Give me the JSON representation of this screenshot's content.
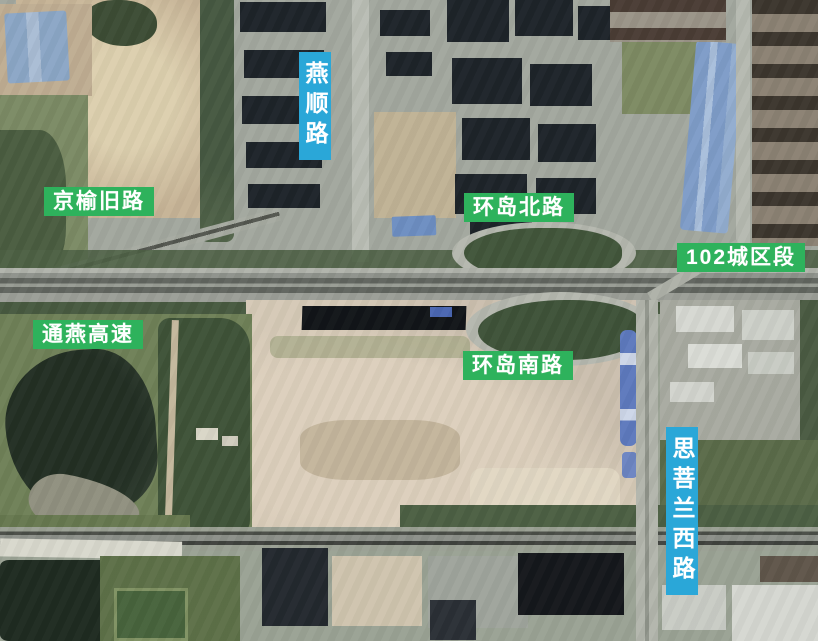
{
  "map": {
    "description": "satellite aerial photo with road-name overlays",
    "labels": {
      "yanshun": {
        "text": "燕顺路",
        "orientation": "vertical",
        "style": "cyan"
      },
      "jingyu": {
        "text": "京榆旧路",
        "orientation": "horizontal",
        "style": "green"
      },
      "huandao_north": {
        "text": "环岛北路",
        "orientation": "horizontal",
        "style": "green"
      },
      "section102": {
        "text": "102城区段",
        "orientation": "horizontal",
        "style": "green"
      },
      "tongyan": {
        "text": "通燕高速",
        "orientation": "horizontal",
        "style": "green"
      },
      "huandao_south": {
        "text": "环岛南路",
        "orientation": "horizontal",
        "style": "green"
      },
      "sipulan": {
        "text": "思菩兰西路",
        "orientation": "vertical",
        "style": "cyan"
      }
    },
    "colors": {
      "label_green": "#2eb25c",
      "label_cyan": "#2aa7d8",
      "label_text": "#ffffff"
    }
  }
}
